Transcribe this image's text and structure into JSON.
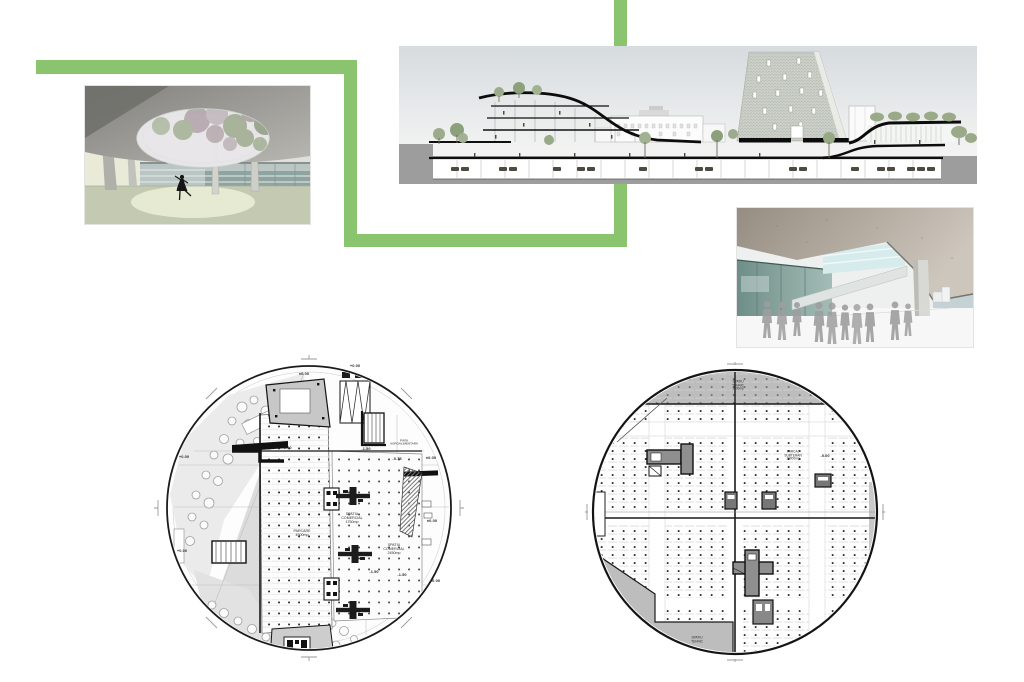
{
  "palette": {
    "accent_green": "#8ac46f",
    "ground_gray": "#9d9d9d",
    "plan_line": "#1a1a1a",
    "shade_gray": "#bdbdbd"
  },
  "plan_left": {
    "labels": {
      "level_top": "±0.00",
      "dim_top": "+0.00",
      "level_a": "-1.50",
      "level_b": "-1.50",
      "piata": "PIATA\nAGROALIMENTARA",
      "level_c": "-0.75",
      "level_d": "±0.00",
      "left_a": "+0.00",
      "left_b": "+0.00",
      "comercial_1": "SPATIU\nCOMERCIAL\n1750mp",
      "parcare": "PARCARE\n4500mp",
      "comercial_2": "SPATIU\nCOMERCIAL\n2450mp",
      "level_e": "-1.50",
      "level_f": "-1.50",
      "level_right": "±0.00",
      "level_br": "±0.00"
    }
  },
  "plan_right": {
    "labels": {
      "tehnic_top": "SPATIU\nTEHNIC\n1600mp",
      "parcaj": "PARCAJ\nSUBTERAN\n16000mp",
      "level": "-5.00",
      "tehnic_bottom": "SPATIU\nTEHNIC"
    }
  }
}
